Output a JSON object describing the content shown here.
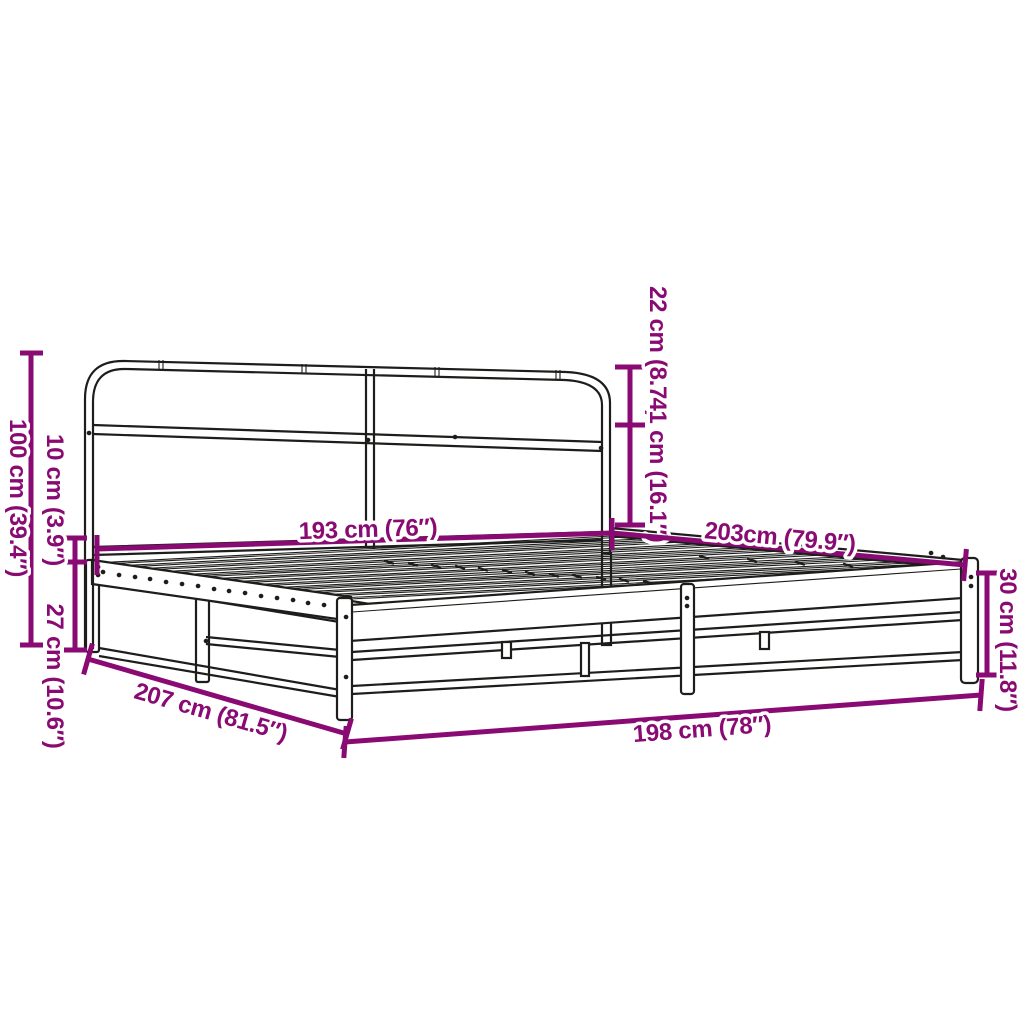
{
  "illustration": {
    "subject": "metal bed frame with headboard, perspective line drawing",
    "colors": {
      "dimension_accent": "#8a0a73",
      "outline": "#1d1d1b",
      "background": "#ffffff"
    }
  },
  "dimensions": {
    "total_height": {
      "label": "100 cm (39.4″)",
      "orientation": "vertical-left"
    },
    "frame_thickness": {
      "label": "10 cm (3.9″)",
      "orientation": "vertical-left"
    },
    "clearance": {
      "label": "27 cm (10.6″)",
      "orientation": "vertical-left"
    },
    "total_length": {
      "label": "207 cm (81.5″)",
      "orientation": "diagonal-bottom-left"
    },
    "headboard_width": {
      "label": "193 cm (76″)",
      "orientation": "horizontal-middle"
    },
    "headboard_top": {
      "label": "22 cm (8.7″)",
      "orientation": "vertical-right-of-headboard"
    },
    "headboard_mid": {
      "label": "41 cm (16.1″)",
      "orientation": "vertical-right-of-headboard"
    },
    "side_length": {
      "label": "203cm (79.9″)",
      "orientation": "diagonal-right"
    },
    "side_height": {
      "label": "30 cm (11.8″)",
      "orientation": "vertical-right"
    },
    "frame_width": {
      "label": "198 cm (78″)",
      "orientation": "diagonal-bottom"
    }
  }
}
